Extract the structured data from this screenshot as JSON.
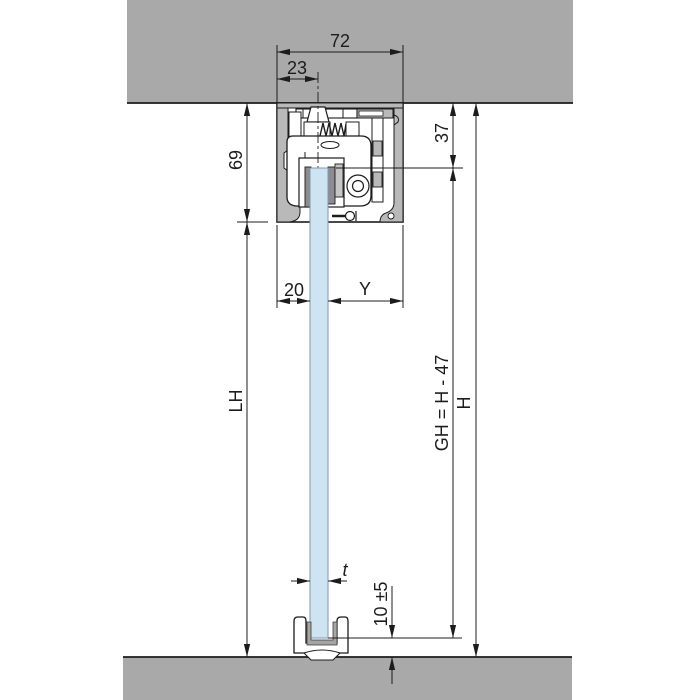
{
  "title": "Glass sliding door system — vertical section drawing",
  "colors": {
    "ceiling": "#a9a9a9",
    "floor": "#a9a9a9",
    "aluminum": "#b9b9b9",
    "aluminum_light": "#c6c6c6",
    "clamp_jaw": "#8d8d8d",
    "glass": "#cfe4f3",
    "line": "#1c1c1c",
    "background": "#ffffff"
  },
  "labels": {
    "track_width": "72",
    "fixing_offset": "23",
    "track_height": "69",
    "ceiling_to_glass_top": "37",
    "glass_inset_left": "20",
    "glass_inset_right": "Y",
    "clear_passage_height": "LH",
    "glass_height_formula": "GH = H - 47",
    "total_height": "H",
    "glass_thickness": "t",
    "floor_clearance": "10 ±5"
  }
}
